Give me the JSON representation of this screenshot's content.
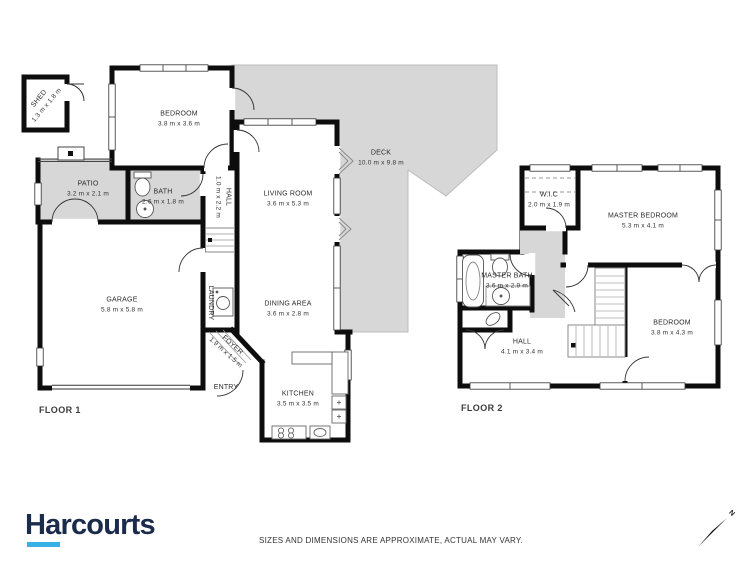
{
  "floor1": {
    "label": "FLOOR 1",
    "rooms": [
      {
        "name": "SHED",
        "dims": "1.3 m x 1.8 m"
      },
      {
        "name": "BEDROOM",
        "dims": "3.8 m x 3.6 m"
      },
      {
        "name": "PATIO",
        "dims": "3.2 m x 2.1 m"
      },
      {
        "name": "BATH",
        "dims": "2.6 m x 1.8 m"
      },
      {
        "name": "HALL",
        "dims": "1.0 m x 2.2 m"
      },
      {
        "name": "LIVING ROOM",
        "dims": "3.6 m x 5.3 m"
      },
      {
        "name": "DECK",
        "dims": "10.0 m x 9.8 m"
      },
      {
        "name": "GARAGE",
        "dims": "5.8 m x 5.8 m"
      },
      {
        "name": "LAUNDRY"
      },
      {
        "name": "FOYER",
        "dims": "1.9 m x 1.5 m"
      },
      {
        "name": "DINING AREA",
        "dims": "3.6 m x 2.8 m"
      },
      {
        "name": "KITCHEN",
        "dims": "3.5 m x 3.5 m"
      },
      {
        "name": "ENTRY"
      }
    ]
  },
  "floor2": {
    "label": "FLOOR 2",
    "rooms": [
      {
        "name": "W.I.C",
        "dims": "2.0 m x 1.9 m"
      },
      {
        "name": "MASTER BEDROOM",
        "dims": "5.3 m x 4.1 m"
      },
      {
        "name": "MASTER BATH",
        "dims": "3.6 m x 2.9 m"
      },
      {
        "name": "HALL",
        "dims": "4.1 m x 3.4 m"
      },
      {
        "name": "BEDROOM",
        "dims": "3.8 m x 4.3 m"
      }
    ]
  },
  "footer": {
    "brand": "Harcourts",
    "disclaimer": "SIZES AND DIMENSIONS ARE APPROXIMATE, ACTUAL MAY VARY.",
    "north": "N"
  },
  "colors": {
    "wall": "#0d0d0d",
    "area_fill": "#d7d7d7",
    "brand_navy": "#1b2b4c",
    "brand_blue": "#35b2e3"
  }
}
